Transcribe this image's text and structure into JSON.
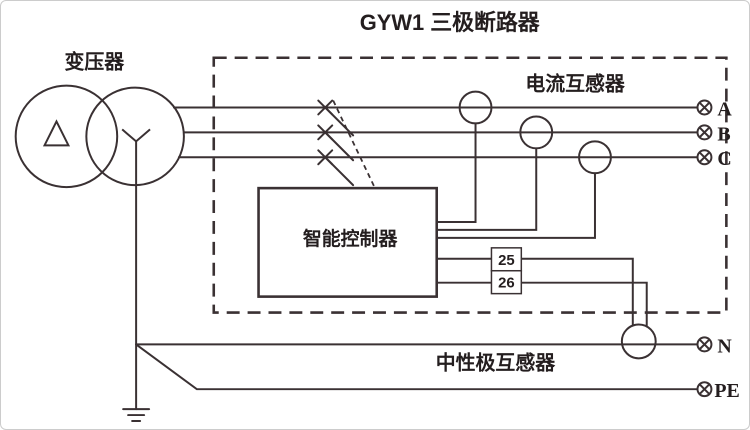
{
  "diagram": {
    "title": "GYW1 三极断路器",
    "labels": {
      "transformer": "变压器",
      "current_transformer": "电流互感器",
      "controller": "智能控制器",
      "neutral_transformer": "中性极互感器"
    },
    "terminals": {
      "a": "A",
      "b": "B",
      "c": "C",
      "n": "N",
      "pe": "PE"
    },
    "controller_terminals": {
      "t25": "25",
      "t26": "26"
    },
    "colors": {
      "line": "#3a3133",
      "text": "#241e1f",
      "background": "#ffffff"
    }
  }
}
